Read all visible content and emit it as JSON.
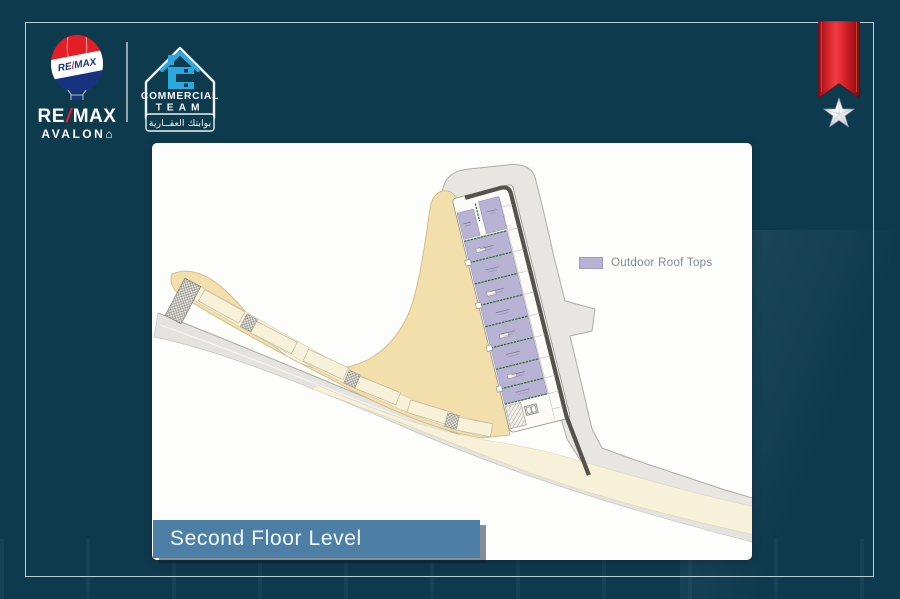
{
  "theme": {
    "bg": "#0e3a4e",
    "frame": "#d7e7ee",
    "panel": "#fdfdfb",
    "banner": "#4d7fa6",
    "bannerText": "#f3f8fb",
    "remaxRed": "#e41e26",
    "remaxBlue": "#17327e",
    "ctBlue": "#2aa9e0",
    "ribbon": "#d41f26",
    "roof": "#b8b3d5",
    "roofBorder": "#8d88b3",
    "sand": "#f2dfab",
    "cream": "#f8f1d9",
    "siteGray": "#e7e6e2",
    "road": "#e4e3e0",
    "wall": "#55534c",
    "green": "#2f6d2f",
    "legendText": "#7f8a8e"
  },
  "header": {
    "remax": {
      "balloon_a": "RE",
      "balloon_slash": "/",
      "balloon_b": "MAX",
      "word_a": "RE",
      "word_slash": "/",
      "word_b": "MAX",
      "subtitle": "AVALON",
      "home_glyph": "⌂"
    },
    "commercial_team": {
      "line1": "COMMERCIAL",
      "line2": "TEAM",
      "tagline_ar": "بوابتك العقــارية"
    }
  },
  "plan": {
    "legend_label": "Outdoor Roof Tops"
  },
  "footer": {
    "title": "Second Floor Level"
  }
}
